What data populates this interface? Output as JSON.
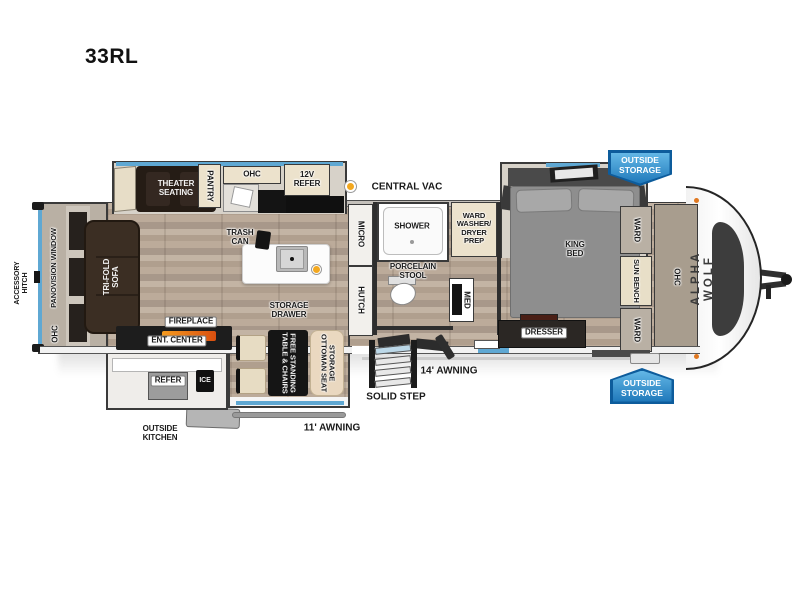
{
  "title": "33RL",
  "colors": {
    "accent_blue": "#5fa8d3",
    "badge_blue": "#2f93cf",
    "badge_blue_dark": "#0d5c9c",
    "vac_dot_orange": "#f3a81f",
    "fireplace_glow": "#e8701a",
    "wood_floor": "#b6a696",
    "furniture_dark_brown": "#3b2e23"
  },
  "badges": {
    "outside_storage_top": "OUTSIDE\nSTORAGE",
    "outside_storage_bottom": "OUTSIDE\nSTORAGE"
  },
  "exterior": {
    "accessory_hitch": "ACCESSORY\nHITCH",
    "central_vac": "CENTRAL VAC",
    "awning_11": "11' AWNING",
    "awning_14": "14' AWNING",
    "solid_step": "SOLID STEP",
    "outside_kitchen": "OUTSIDE\nKITCHEN",
    "brand": "ALPHA WOLF"
  },
  "rear": {
    "panovision_window": "PANOVISION WINDOW",
    "ohc": "OHC",
    "sofa": "TRI-FOLD\nSOFA"
  },
  "kitchen_slide": {
    "theater_seating": "THEATER\nSEATING",
    "pantry": "PANTRY",
    "ohc": "OHC",
    "refer_12v": "12V\nREFER"
  },
  "galley": {
    "trash_can": "TRASH\nCAN",
    "storage_drawer": "STORAGE\nDRAWER",
    "table": "FREE STANDING\nTABLE & CHAIRS",
    "ottoman": "STORAGE\nOTTOMAN SEAT",
    "fireplace": "FIREPLACE",
    "ent_center": "ENT. CENTER",
    "outside_refer": "REFER",
    "ice": "ICE"
  },
  "bath": {
    "micro": "MICRO",
    "hutch": "HUTCH",
    "shower": "SHOWER",
    "ward_washer_dryer": "WARD\nWASHER/\nDRYER\nPREP",
    "porcelain_stool": "PORCELAIN\nSTOOL",
    "med": "MED"
  },
  "bedroom": {
    "king_bed": "KING\nBED",
    "dresser": "DRESSER",
    "ward_top": "WARD",
    "sun_bench": "SUN BENCH",
    "ward_bottom": "WARD",
    "ohc": "OHC"
  }
}
